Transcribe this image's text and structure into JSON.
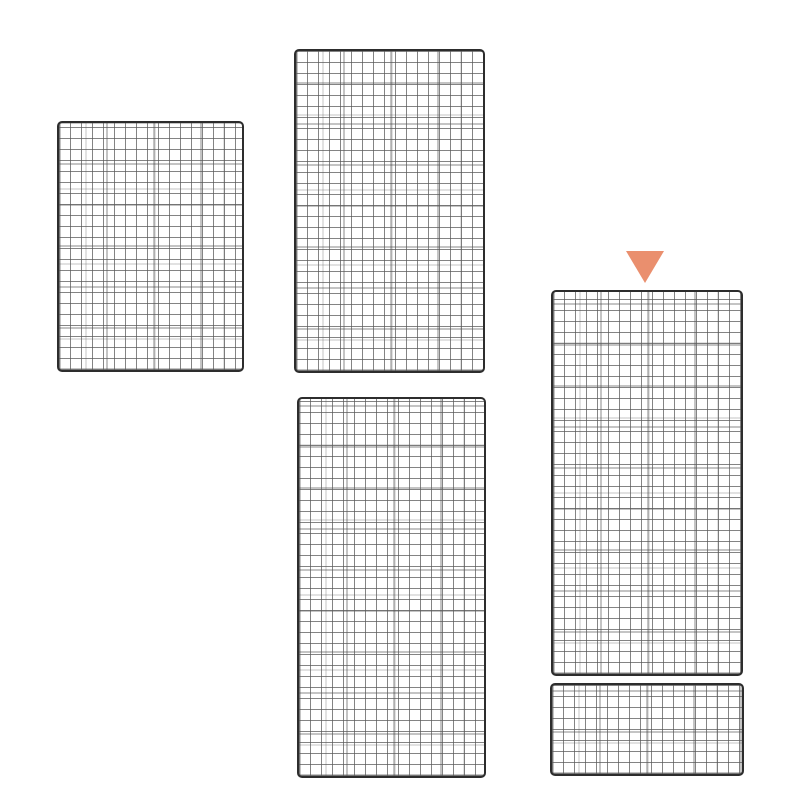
{
  "canvas": {
    "width_px": 800,
    "height_px": 800,
    "background_color": "#ffffff",
    "description": "Five black wire mesh grid panels of different sizes on a white background; an orange triangle marker points down at the tall right-hand panel."
  },
  "mesh_style": {
    "border_color": "#2d2d2d",
    "wire_color": "#8d8d8d",
    "cell_pitch_px": 11,
    "corner_radius_px": 5
  },
  "panels": [
    {
      "name": "grid-panel-top-left",
      "columns": 17,
      "rows": 23,
      "style": "left:57px;top:121px;width:187px;height:251px"
    },
    {
      "name": "grid-panel-top-middle",
      "columns": 17,
      "rows": 29,
      "style": "left:294px;top:49px;width:191px;height:324px"
    },
    {
      "name": "grid-panel-bottom-middle",
      "columns": 17,
      "rows": 35,
      "style": "left:297px;top:397px;width:189px;height:381px"
    },
    {
      "name": "grid-panel-right",
      "columns": 17,
      "rows": 35,
      "highlighted_by_marker": true,
      "style": "left:551px;top:290px;width:192px;height:386px"
    },
    {
      "name": "grid-panel-bottom-right",
      "columns": 18,
      "rows": 8,
      "style": "left:550px;top:683px;width:194px;height:93px"
    }
  ],
  "marker": {
    "shape": "triangle-down",
    "color": "#EA8F6E",
    "points_at": "grid-panel-right",
    "style": "left:626px;top:251px;border-top:32px solid #EA8F6E"
  }
}
